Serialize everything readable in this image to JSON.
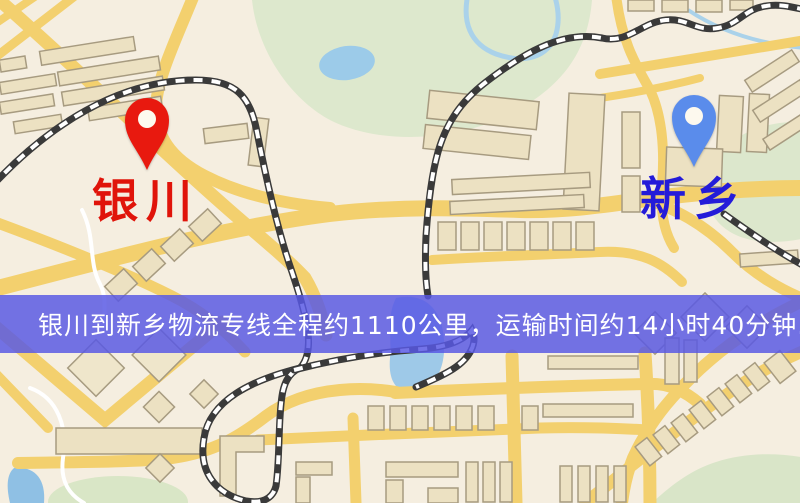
{
  "map": {
    "banner": {
      "text": "银川到新乡物流专线全程约1110公里，运输时间约14小时40分钟.",
      "background_color": "#5858e4",
      "text_color": "#ffffff"
    },
    "markers": [
      {
        "id": "origin",
        "city": "银川",
        "pin_color": "#e8190f",
        "label_color": "#e0140a"
      },
      {
        "id": "destination",
        "city": "新乡",
        "pin_color": "#5a8ceb",
        "label_color": "#241bd9"
      }
    ],
    "route_info": {
      "origin_city": "银川",
      "destination_city": "新乡",
      "service_type": "物流专线",
      "distance_text": "约1110公里",
      "distance_km": 1110,
      "duration_text": "约14小时40分钟"
    },
    "colors": {
      "land": "#f5eee0",
      "road": "#f3d06e",
      "building": "#ece1c2",
      "green_area": "#dce7cc",
      "water": "#a3cee9",
      "railway_dark": "#3a3a3a"
    }
  }
}
